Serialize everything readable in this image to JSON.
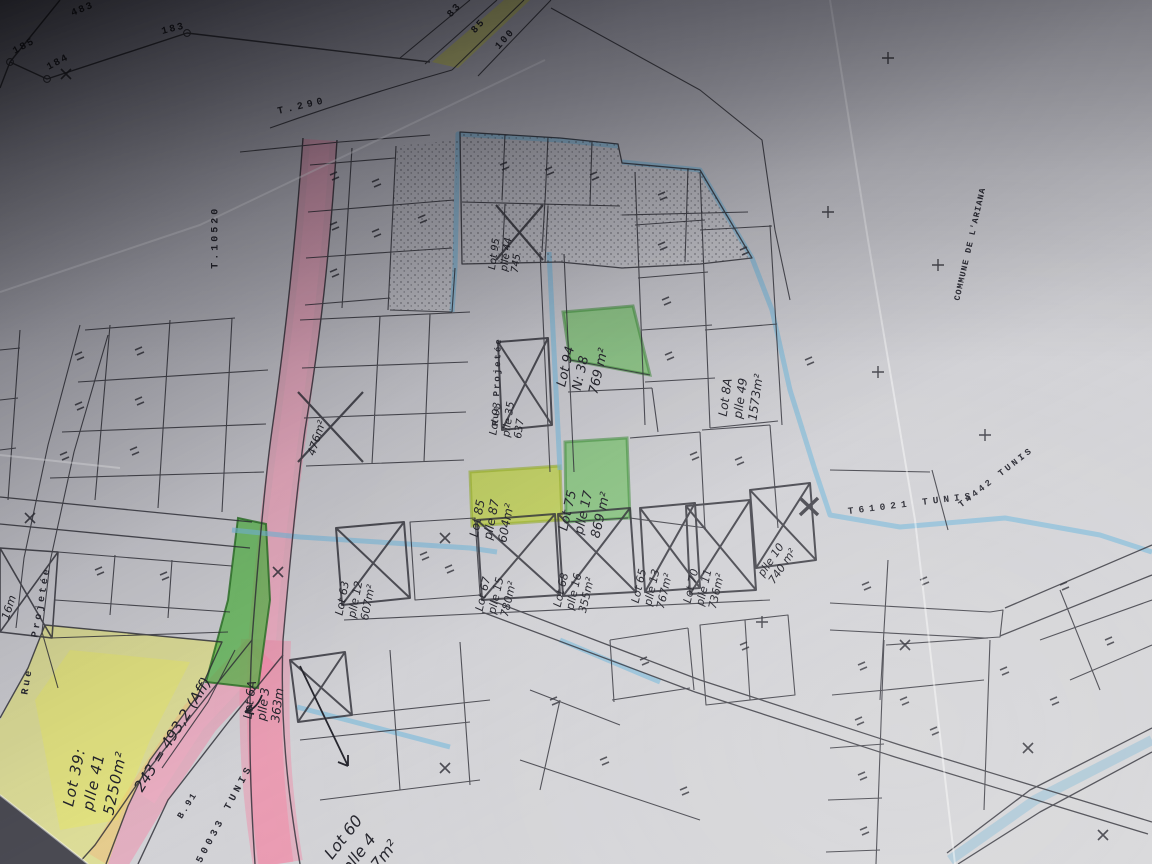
{
  "photo": {
    "description": "Hand-annotated cadastral survey map photograph, Tunis region",
    "colors": {
      "highlight_pink": "#f27ba2",
      "highlight_yellow": "#e9e95c",
      "highlight_green": "#5fbe50",
      "highlight_lime": "#b4cd2e",
      "highlight_blue": "#6eb4dc",
      "ink": "#23232b"
    }
  },
  "printed": {
    "t290": "T.290",
    "t10520": "T.10520",
    "t61021": "T61021 TUNIS",
    "t4442": "T4442 TUNIS",
    "commune": "COMMUNE DE L'ARIANA",
    "b91": "B.91",
    "tunis_50033": "50033 TUNIS",
    "rue_projetee_left": "Rue Projetée",
    "rue_projetee_mid": "Rue Projetée",
    "width_16m": "16m"
  },
  "survey_numbers": {
    "n185": "185",
    "n184": "184",
    "n183": "183",
    "n483": "483",
    "n83": "83",
    "n85": "85",
    "n100": "100"
  },
  "lots": {
    "lot39": {
      "l1": "Lot 39:",
      "l2": "plle 41",
      "l3": "5250m²"
    },
    "lot6a": {
      "l1": "Lot 6A",
      "l2": "plle 3",
      "l3": "363m"
    },
    "lot60": {
      "l1": "Lot 60",
      "l2": "plle 4",
      "l3": "847m²"
    },
    "lot93": {
      "l1": "Lot 93",
      "l2": "plle 35",
      "l3": "637"
    },
    "lot94": {
      "l1": "Lot 94",
      "l2": "N: 38",
      "l3": "769 m²"
    },
    "lot95": {
      "l1": "Lot 95",
      "l2": "plle 44",
      "l3": "745"
    },
    "lot85": {
      "l1": "Lot 85",
      "l2": "plle 87",
      "l3": "604m²"
    },
    "lot75": {
      "l1": "Lot 75",
      "l2": "plle 17",
      "l3": "869 m²"
    },
    "lot8a": {
      "l1": "Lot 8A",
      "l2": "plle 49",
      "l3": "1573m²"
    },
    "lot63": {
      "l1": "Lot 63",
      "l2": "plle 12",
      "l3": "607m²"
    },
    "lot67": {
      "l1": "Lot 67",
      "l2": "plle 15",
      "l3": "780m²"
    },
    "lot68": {
      "l1": "Lot 68",
      "l2": "plle 16",
      "l3": "355m²"
    },
    "lot65": {
      "l1": "Lot 65",
      "l2": "plle 13",
      "l3": "767m²"
    },
    "lot70": {
      "l1": "Lot 70",
      "l2": "plle 11",
      "l3": "736m²"
    },
    "lot740": {
      "l1": "plle 10",
      "l2": "740 m²"
    },
    "lot476": {
      "l1": "476m²"
    }
  },
  "annotations": {
    "calc": "243 = 493,2 (Aff)"
  }
}
